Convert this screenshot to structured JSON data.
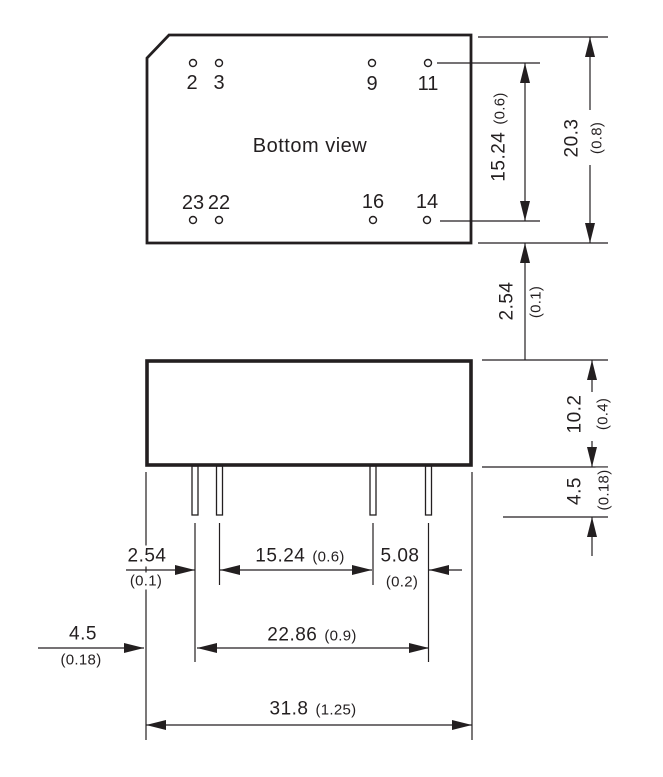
{
  "drawing": {
    "type": "package outline dimensional drawing",
    "units_note": "millimeters (inches)"
  },
  "colors": {
    "ink": "#231f20",
    "background": "#ffffff"
  },
  "bottom_view": {
    "label": "Bottom view",
    "pins_top": [
      "2",
      "3",
      "9",
      "11"
    ],
    "pins_bottom": [
      "23",
      "22",
      "16",
      "14"
    ]
  },
  "dimensions": {
    "pin_row_spacing_vertical": {
      "mm": "15.24",
      "inch": "(0.6)"
    },
    "body_depth": {
      "mm": "20.3",
      "inch": "(0.8)"
    },
    "pin_row_edge_offset": {
      "mm": "2.54",
      "inch": "(0.1)"
    },
    "body_height": {
      "mm": "10.2",
      "inch": "(0.4)"
    },
    "pin_length_side": {
      "mm": "4.5",
      "inch": "(0.18)"
    },
    "pin_pitch": {
      "mm": "2.54",
      "inch": "(0.1)"
    },
    "pin_group_gap": {
      "mm": "15.24",
      "inch": "(0.6)"
    },
    "pin_gap_right": {
      "mm": "5.08",
      "inch": "(0.2)"
    },
    "pin_edge_offset": {
      "mm": "4.5",
      "inch": "(0.18)"
    },
    "pin_span": {
      "mm": "22.86",
      "inch": "(0.9)"
    },
    "body_width": {
      "mm": "31.8",
      "inch": "(1.25)"
    }
  }
}
